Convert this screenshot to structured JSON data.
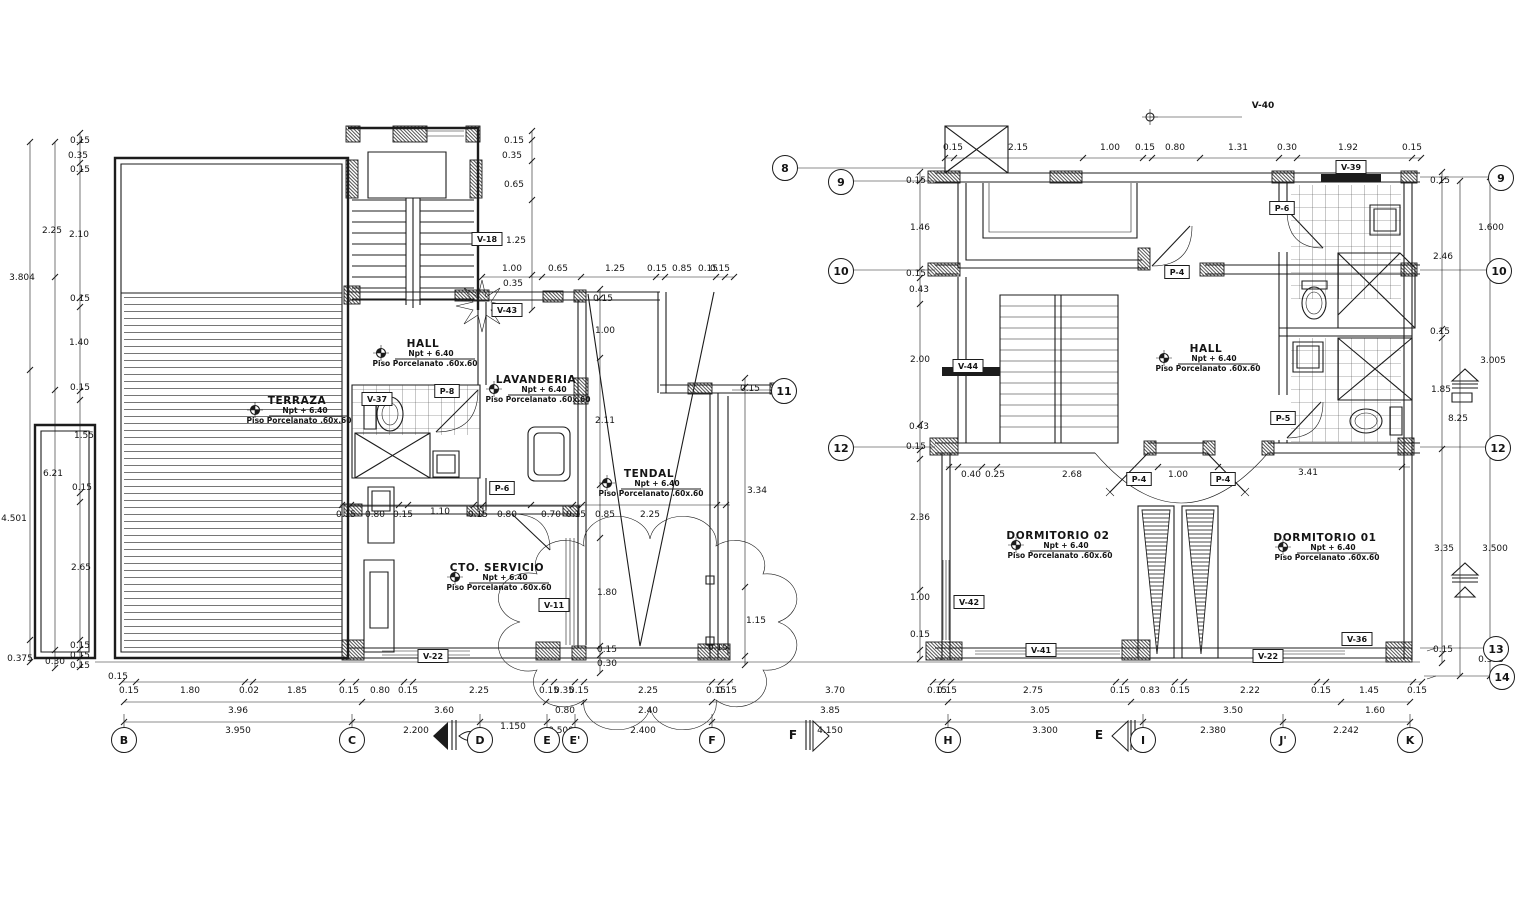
{
  "drawing": {
    "type": "architectural floor plan - second level, two plan views",
    "ink_color": "#1c1c1c",
    "background": "#ffffff"
  },
  "rooms": [
    {
      "name": "TERRAZA",
      "npt": "Npt + 6.40",
      "floor": "Piso Porcelanato .60x.60",
      "x": 297,
      "y": 401
    },
    {
      "name": "HALL",
      "npt": "Npt + 6.40",
      "floor": "Piso Porcelanato .60x.60",
      "x": 423,
      "y": 344
    },
    {
      "name": "LAVANDERIA",
      "npt": "Npt + 6.40",
      "floor": "Piso Porcelanato .60x.60",
      "x": 536,
      "y": 380
    },
    {
      "name": "TENDAL",
      "npt": "Npt + 6.40",
      "floor": "Piso Porcelanato .60x.60",
      "x": 649,
      "y": 474
    },
    {
      "name": "CTO. SERVICIO",
      "npt": "Npt + 6.40",
      "floor": "Piso Porcelanato .60x.60",
      "x": 497,
      "y": 568
    },
    {
      "name": "HALL",
      "npt": "Npt + 6.40",
      "floor": "Piso Porcelanato .60x.60",
      "x": 1206,
      "y": 349
    },
    {
      "name": "DORMITORIO 02",
      "npt": "Npt + 6.40",
      "floor": "Piso Porcelanato .60x.60",
      "x": 1058,
      "y": 536
    },
    {
      "name": "DORMITORIO 01",
      "npt": "Npt + 6.40",
      "floor": "Piso Porcelanato .60x.60",
      "x": 1325,
      "y": 538
    }
  ],
  "tags": [
    {
      "t": "V-18",
      "x": 487,
      "y": 239
    },
    {
      "t": "V-43",
      "x": 507,
      "y": 310
    },
    {
      "t": "V-37",
      "x": 377,
      "y": 399
    },
    {
      "t": "P-8",
      "x": 447,
      "y": 391
    },
    {
      "t": "P-6",
      "x": 502,
      "y": 488
    },
    {
      "t": "V-11",
      "x": 554,
      "y": 605
    },
    {
      "t": "V-22",
      "x": 433,
      "y": 656
    },
    {
      "t": "V-39",
      "x": 1351,
      "y": 167
    },
    {
      "t": "P-6",
      "x": 1282,
      "y": 208
    },
    {
      "t": "P-4",
      "x": 1177,
      "y": 272
    },
    {
      "t": "V-44",
      "x": 968,
      "y": 366
    },
    {
      "t": "P-5",
      "x": 1283,
      "y": 418
    },
    {
      "t": "P-4",
      "x": 1139,
      "y": 479
    },
    {
      "t": "P-4",
      "x": 1223,
      "y": 479
    },
    {
      "t": "V-42",
      "x": 969,
      "y": 602
    },
    {
      "t": "V-41",
      "x": 1041,
      "y": 650
    },
    {
      "t": "V-22",
      "x": 1268,
      "y": 656
    },
    {
      "t": "V-36",
      "x": 1357,
      "y": 639
    }
  ],
  "bubbles": [
    {
      "t": "B",
      "x": 124,
      "y": 740
    },
    {
      "t": "C",
      "x": 352,
      "y": 740
    },
    {
      "t": "D",
      "x": 480,
      "y": 740
    },
    {
      "t": "E",
      "x": 547,
      "y": 740
    },
    {
      "t": "E'",
      "x": 575,
      "y": 740
    },
    {
      "t": "F",
      "x": 712,
      "y": 740
    },
    {
      "t": "H",
      "x": 948,
      "y": 740
    },
    {
      "t": "I",
      "x": 1143,
      "y": 740
    },
    {
      "t": "J'",
      "x": 1283,
      "y": 740
    },
    {
      "t": "K",
      "x": 1410,
      "y": 740
    },
    {
      "t": "8",
      "x": 785,
      "y": 168
    },
    {
      "t": "9",
      "x": 841,
      "y": 182
    },
    {
      "t": "10",
      "x": 841,
      "y": 271
    },
    {
      "t": "12",
      "x": 841,
      "y": 448
    },
    {
      "t": "11",
      "x": 784,
      "y": 391
    },
    {
      "t": "9",
      "x": 1501,
      "y": 178
    },
    {
      "t": "10",
      "x": 1499,
      "y": 271
    },
    {
      "t": "12",
      "x": 1498,
      "y": 448
    },
    {
      "t": "13",
      "x": 1496,
      "y": 649
    },
    {
      "t": "14",
      "x": 1502,
      "y": 677
    }
  ],
  "markers": [
    {
      "t": "F",
      "x": 793,
      "y": 739
    },
    {
      "t": "E",
      "x": 1099,
      "y": 739
    }
  ],
  "annotations": [
    {
      "t": "V-40",
      "x": 1263,
      "y": 108
    }
  ],
  "dims": [
    [
      "0.15",
      129,
      690
    ],
    [
      "1.80",
      190,
      690
    ],
    [
      "0.02",
      249,
      690
    ],
    [
      "1.85",
      297,
      690
    ],
    [
      "0.15",
      349,
      690
    ],
    [
      "0.80",
      380,
      690
    ],
    [
      "0.15",
      408,
      690
    ],
    [
      "2.25",
      479,
      690
    ],
    [
      "0.15",
      549,
      690
    ],
    [
      "0.35",
      564,
      690
    ],
    [
      "0.15",
      579,
      690
    ],
    [
      "2.25",
      648,
      690
    ],
    [
      "0.15",
      716,
      690
    ],
    [
      "0.15",
      727,
      690
    ],
    [
      "3.70",
      835,
      690
    ],
    [
      "0.15",
      937,
      690
    ],
    [
      "0.15",
      947,
      690
    ],
    [
      "2.75",
      1033,
      690
    ],
    [
      "0.15",
      1120,
      690
    ],
    [
      "0.83",
      1150,
      690
    ],
    [
      "0.15",
      1180,
      690
    ],
    [
      "2.22",
      1250,
      690
    ],
    [
      "0.15",
      1321,
      690
    ],
    [
      "1.45",
      1369,
      690
    ],
    [
      "0.15",
      1417,
      690
    ],
    [
      "3.96",
      238,
      710
    ],
    [
      "3.60",
      444,
      710
    ],
    [
      "0.80",
      565,
      710
    ],
    [
      "2.40",
      648,
      710
    ],
    [
      "3.85",
      830,
      710
    ],
    [
      "3.05",
      1040,
      710
    ],
    [
      "3.50",
      1233,
      710
    ],
    [
      "1.60",
      1375,
      710
    ],
    [
      "3.950",
      238,
      730
    ],
    [
      "2.200",
      416,
      730
    ],
    [
      "1.150",
      513,
      726
    ],
    [
      "0.500",
      561,
      730
    ],
    [
      "2.400",
      643,
      730
    ],
    [
      "4.150",
      830,
      730
    ],
    [
      "3.300",
      1045,
      730
    ],
    [
      "2.380",
      1213,
      730
    ],
    [
      "2.242",
      1346,
      730
    ],
    [
      "0.15",
      80,
      140
    ],
    [
      "0.35",
      78,
      155
    ],
    [
      "0.15",
      80,
      169
    ],
    [
      "2.25",
      52,
      230
    ],
    [
      "2.10",
      79,
      234
    ],
    [
      "3.804",
      22,
      277
    ],
    [
      "0.15",
      80,
      298
    ],
    [
      "1.40",
      79,
      342
    ],
    [
      "0.15",
      80,
      387
    ],
    [
      "1.55",
      84,
      435
    ],
    [
      "6.21",
      53,
      473
    ],
    [
      "0.15",
      82,
      487
    ],
    [
      "4.501",
      14,
      518
    ],
    [
      "2.65",
      81,
      567
    ],
    [
      "0.15",
      80,
      645
    ],
    [
      "0.15",
      80,
      655
    ],
    [
      "0.15",
      80,
      665
    ],
    [
      "0.30",
      55,
      661
    ],
    [
      "0.375",
      20,
      658
    ],
    [
      "0.15",
      118,
      676
    ],
    [
      "0.15",
      514,
      140
    ],
    [
      "0.35",
      512,
      155
    ],
    [
      "0.65",
      514,
      184
    ],
    [
      "1.25",
      516,
      240
    ],
    [
      "1.00",
      512,
      268
    ],
    [
      "0.65",
      558,
      268
    ],
    [
      "1.25",
      615,
      268
    ],
    [
      "0.15",
      657,
      268
    ],
    [
      "0.85",
      682,
      268
    ],
    [
      "0.15",
      708,
      268
    ],
    [
      "0.15",
      720,
      268
    ],
    [
      "0.35",
      513,
      283
    ],
    [
      "0.15",
      603,
      298
    ],
    [
      "1.00",
      605,
      330
    ],
    [
      "2.11",
      605,
      420
    ],
    [
      "1.80",
      607,
      592
    ],
    [
      "0.15",
      607,
      649
    ],
    [
      "0.30",
      607,
      663
    ],
    [
      "0.15",
      750,
      388
    ],
    [
      "3.34",
      757,
      490
    ],
    [
      "1.15",
      756,
      620
    ],
    [
      "0.15",
      718,
      647
    ],
    [
      "0.15",
      346,
      514
    ],
    [
      "0.80",
      375,
      514
    ],
    [
      "0.15",
      403,
      514
    ],
    [
      "1.10",
      440,
      511
    ],
    [
      "0.15",
      478,
      514
    ],
    [
      "0.80",
      507,
      514
    ],
    [
      "0.70",
      551,
      514
    ],
    [
      "0.15",
      576,
      514
    ],
    [
      "0.85",
      605,
      514
    ],
    [
      "2.25",
      650,
      514
    ],
    [
      "0.15",
      953,
      147
    ],
    [
      "2.15",
      1018,
      147
    ],
    [
      "1.00",
      1110,
      147
    ],
    [
      "0.15",
      1145,
      147
    ],
    [
      "0.80",
      1175,
      147
    ],
    [
      "1.31",
      1238,
      147
    ],
    [
      "0.30",
      1287,
      147
    ],
    [
      "1.92",
      1348,
      147
    ],
    [
      "0.15",
      1412,
      147
    ],
    [
      "0.15",
      916,
      180
    ],
    [
      "1.46",
      920,
      227
    ],
    [
      "0.15",
      916,
      273
    ],
    [
      "0.43",
      919,
      289
    ],
    [
      "2.00",
      920,
      359
    ],
    [
      "0.43",
      919,
      426
    ],
    [
      "0.15",
      916,
      446
    ],
    [
      "2.36",
      920,
      517
    ],
    [
      "1.00",
      920,
      597
    ],
    [
      "0.15",
      920,
      634
    ],
    [
      "0.40",
      971,
      474
    ],
    [
      "0.25",
      995,
      474
    ],
    [
      "2.68",
      1072,
      474
    ],
    [
      "1.00",
      1178,
      474
    ],
    [
      "3.41",
      1308,
      472
    ],
    [
      "0.15",
      1440,
      180
    ],
    [
      "2.46",
      1443,
      256
    ],
    [
      "0.15",
      1440,
      331
    ],
    [
      "1.85",
      1441,
      389
    ],
    [
      "8.25",
      1458,
      418
    ],
    [
      "3.35",
      1444,
      548
    ],
    [
      "0.15",
      1443,
      649
    ],
    [
      "1.600",
      1491,
      227
    ],
    [
      "3.005",
      1493,
      360
    ],
    [
      "3.500",
      1495,
      548
    ],
    [
      "0.375",
      1491,
      659
    ]
  ]
}
